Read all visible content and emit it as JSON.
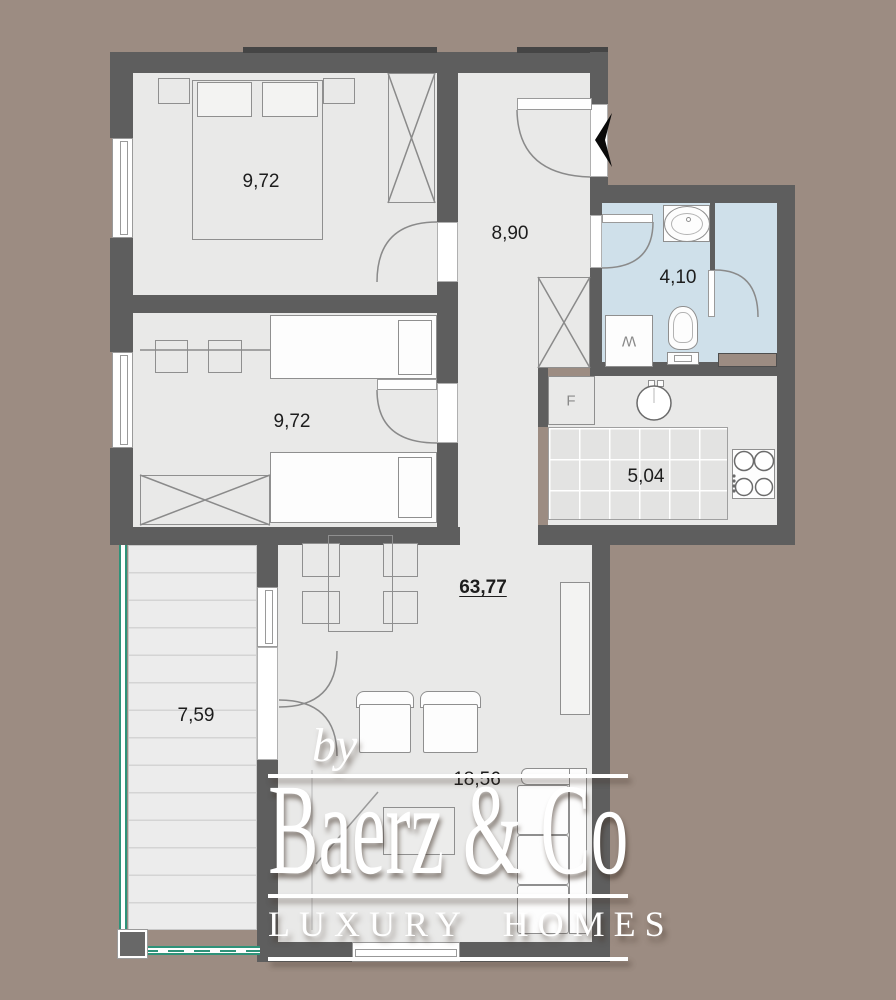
{
  "colors": {
    "background": "#9c8c82",
    "wall": "#5e5e5e",
    "wall_dark": "#454545",
    "floor": "#e9e9e8",
    "bath_floor": "#cfe0ea",
    "tile_floor": "#e3e3e2",
    "balcony_floor": "#ececec",
    "balcony_slat": "#d4d4d4",
    "railing_green": "#2e9279",
    "outline": "#8f8f8f",
    "label": "#1d1d1d",
    "appliance_label": "#8a8a8a",
    "watermark": "#ffffff"
  },
  "rooms": {
    "bedroom1": {
      "area": "9,72"
    },
    "bedroom2": {
      "area": "9,72"
    },
    "hallway": {
      "area": "8,90"
    },
    "bathroom": {
      "area": "4,10"
    },
    "kitchen": {
      "area": "5,04"
    },
    "living_room": {
      "area": "18,56"
    },
    "balcony": {
      "area": "7,59"
    },
    "total_area": "63,77"
  },
  "appliances": {
    "fridge": "F",
    "washing_machine": "W"
  },
  "watermark": {
    "prefix": "by",
    "brand": "Baerz & Co",
    "tagline": "LUXURY HOMES"
  }
}
